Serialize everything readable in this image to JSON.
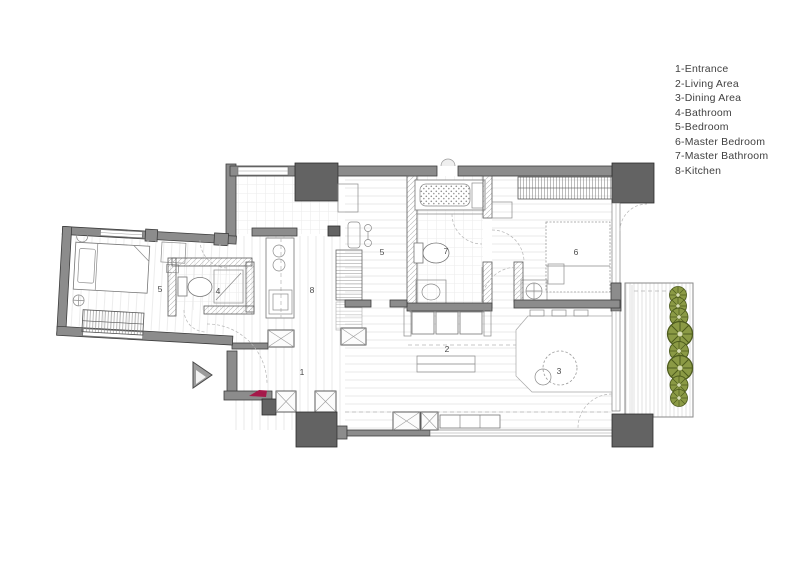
{
  "legend": {
    "items": [
      {
        "id": "1",
        "name": "Entrance",
        "text": "1-Entrance"
      },
      {
        "id": "2",
        "name": "Living Area",
        "text": "2-Living Area"
      },
      {
        "id": "3",
        "name": "Dining Area",
        "text": "3-Dining Area"
      },
      {
        "id": "4",
        "name": "Bathroom",
        "text": "4-Bathroom"
      },
      {
        "id": "5",
        "name": "Bedroom",
        "text": "5-Bedroom"
      },
      {
        "id": "6",
        "name": "Master Bedroom",
        "text": "6-Master Bedroom"
      },
      {
        "id": "7",
        "name": "Master Bathroom",
        "text": "7-Master Bathroom"
      },
      {
        "id": "8",
        "name": "Kitchen",
        "text": "8-Kitchen"
      }
    ]
  },
  "plan": {
    "room_numbers": {
      "entrance": "1",
      "living_area": "2",
      "dining_area": "3",
      "bathroom": "4",
      "bedroom": "5",
      "master_bedroom": "6",
      "master_bathroom": "7",
      "kitchen": "8"
    }
  },
  "colors": {
    "wall": "#8c8c8c",
    "wall-dark": "#636363",
    "accent-red": "#a5194a",
    "tree-green": "#8b9a45",
    "tree-dark": "#4e5c1e",
    "floor-line": "#e3e3e3"
  }
}
